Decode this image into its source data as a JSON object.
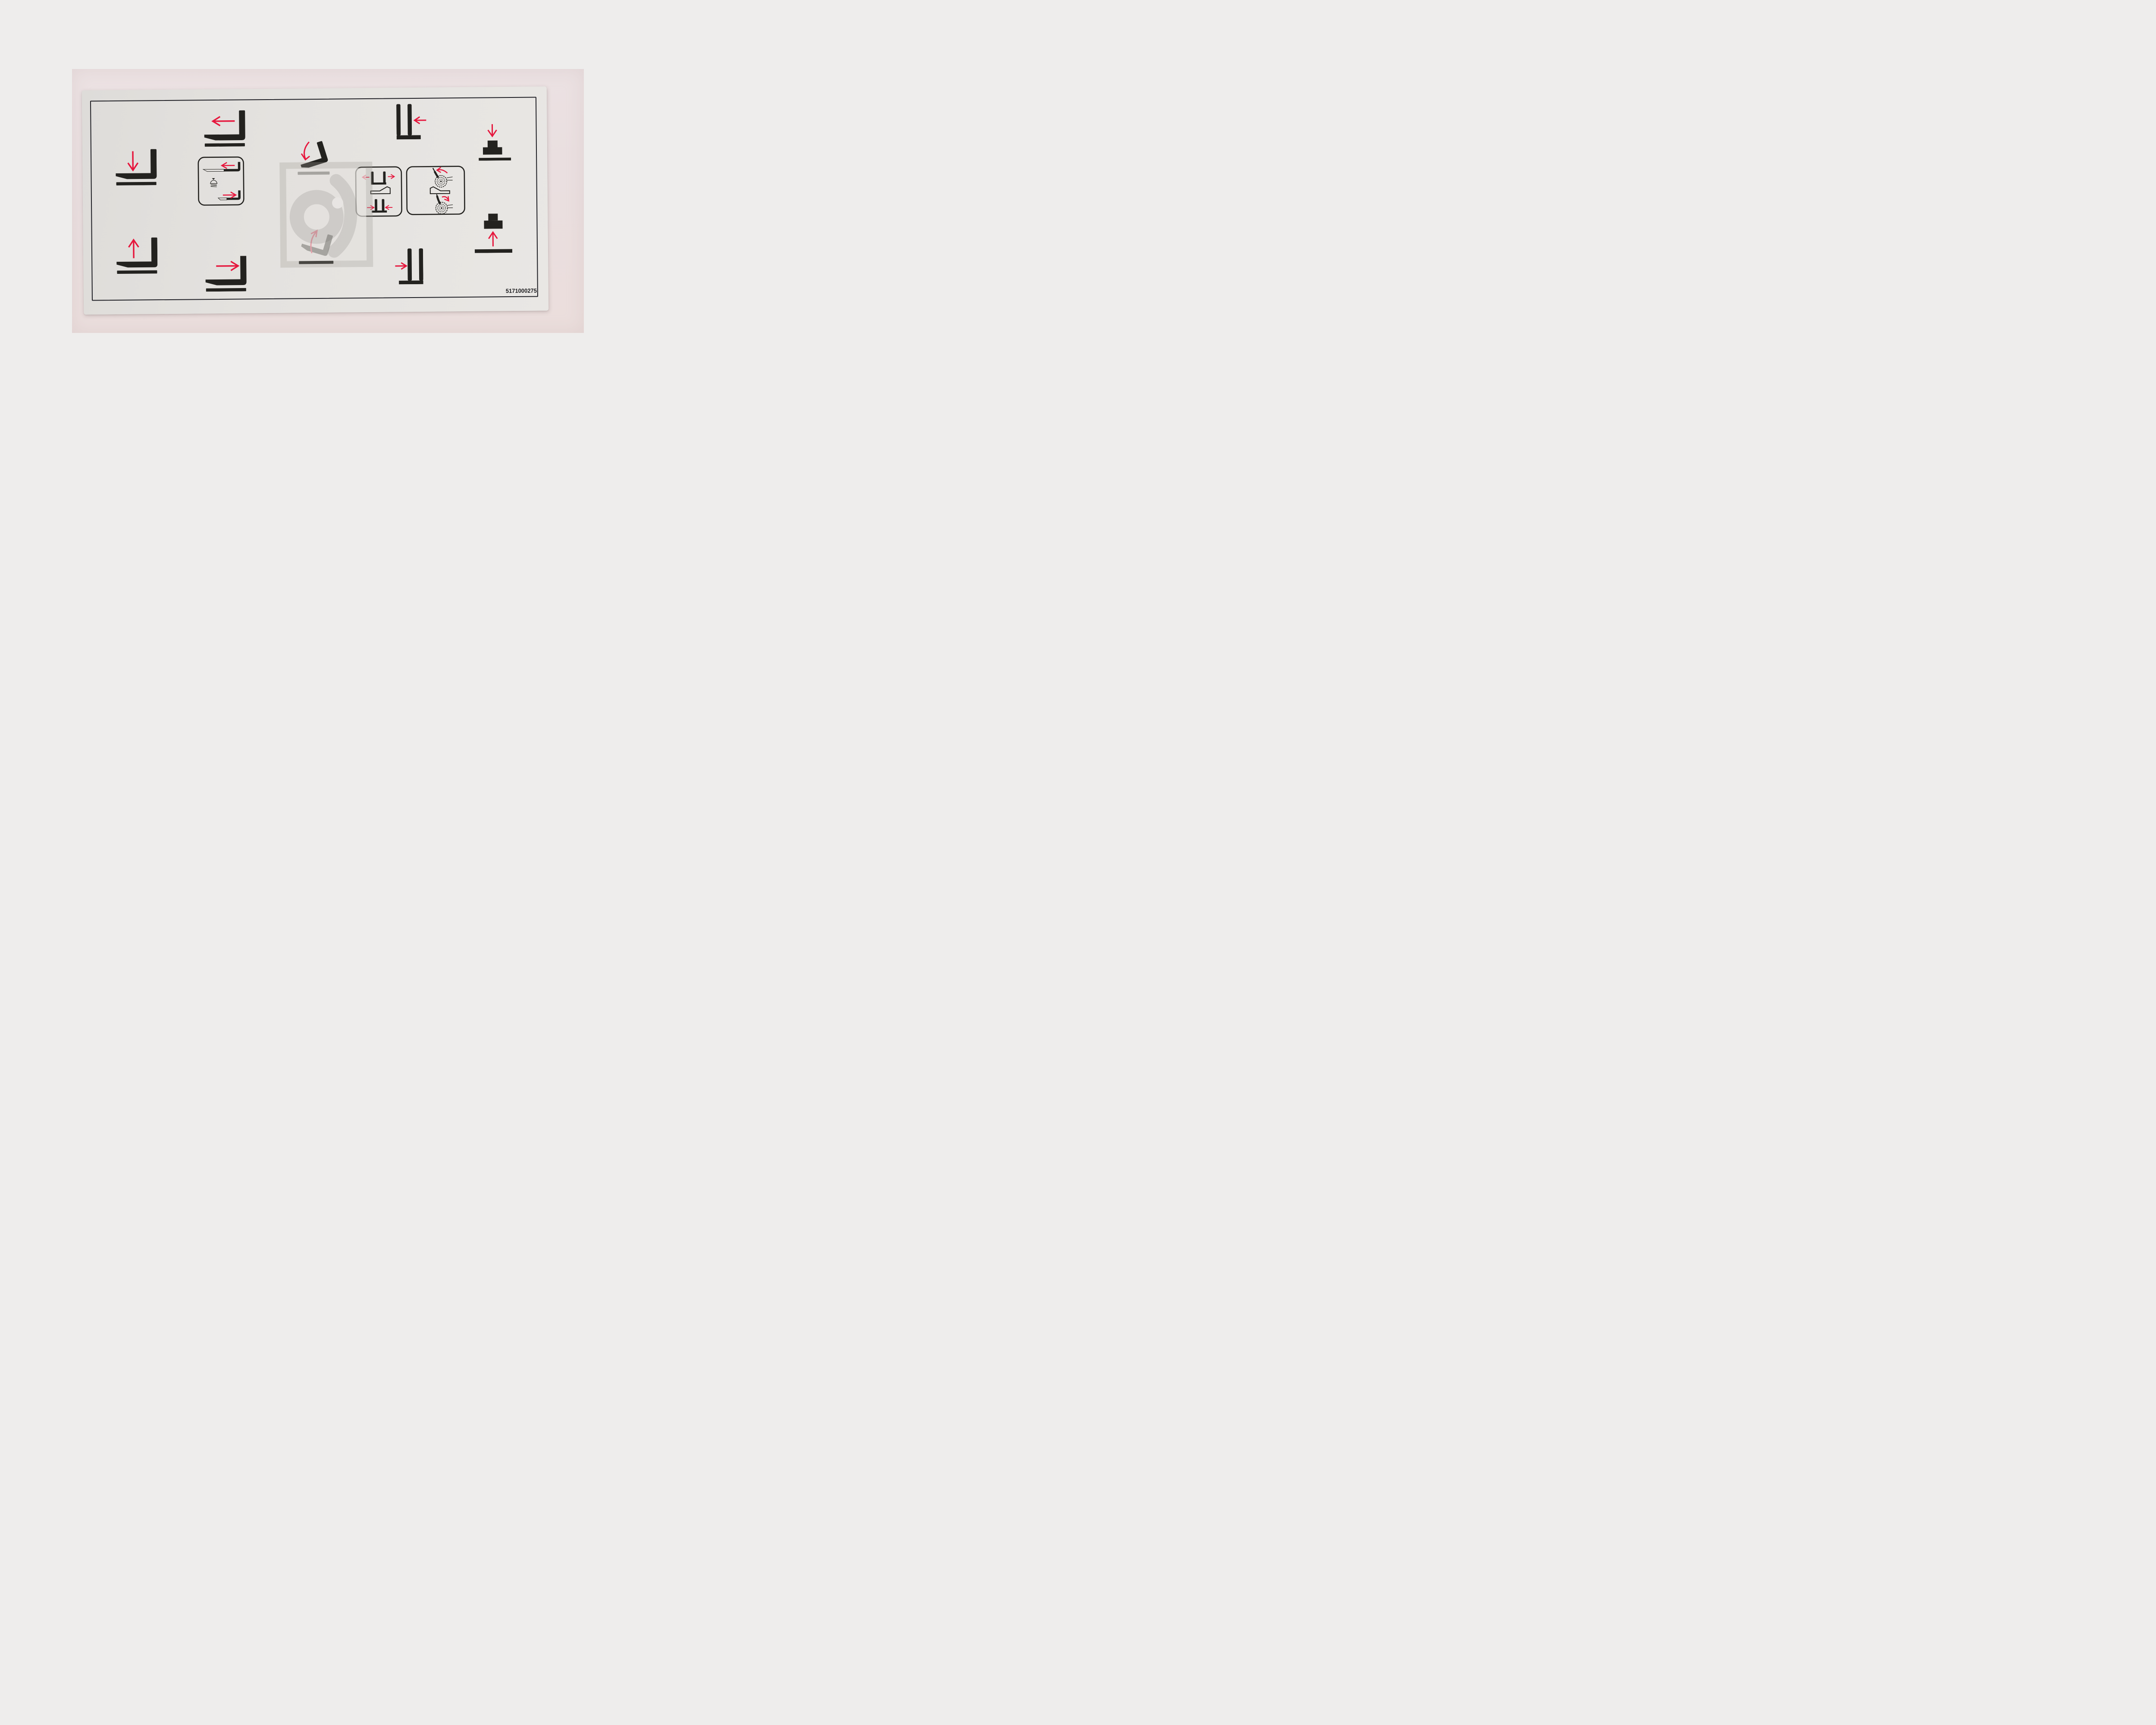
{
  "page": {
    "background_color": "#eeedec"
  },
  "photo": {
    "background_color": "#eadfdf",
    "subject": "control pictogram decal sticker"
  },
  "decal": {
    "part_number": "5171000275",
    "colors": {
      "ink_black": "#23221f",
      "arrow_red": "#e6173d",
      "sticker_face": "#e3e1de",
      "border_line": "#1e1e24",
      "page_background": "#eeedec"
    },
    "pictograms": [
      {
        "id": "fork-lower",
        "label": "Lower forks",
        "arrow": "down"
      },
      {
        "id": "fork-raise",
        "label": "Raise forks",
        "arrow": "up"
      },
      {
        "id": "fork-shift-left",
        "label": "Shift forks left",
        "arrow": "left"
      },
      {
        "id": "fork-shift-right",
        "label": "Shift forks right",
        "arrow": "right"
      },
      {
        "id": "sideshift-detent",
        "label": "Side shift left / right with detent button",
        "arrows": [
          "left",
          "right"
        ]
      },
      {
        "id": "tilt-forward",
        "label": "Tilt forks forward / down",
        "arrow": "curved-down"
      },
      {
        "id": "tilt-back",
        "label": "Tilt forks back / up",
        "arrow": "curved-up"
      },
      {
        "id": "fork-spread-close",
        "label": "Spread forks apart / bring forks together",
        "arrows": [
          "outward",
          "inward"
        ]
      },
      {
        "id": "clamp-rotate",
        "label": "Rotate roll clamp counter-clockwise / clockwise",
        "arrows": [
          "ccw",
          "cw"
        ]
      },
      {
        "id": "carriage-shift-left",
        "label": "Move carriage left",
        "arrow": "left"
      },
      {
        "id": "carriage-shift-right",
        "label": "Move carriage right",
        "arrow": "right"
      },
      {
        "id": "platform-lower",
        "label": "Lower load block",
        "arrow": "down"
      },
      {
        "id": "platform-raise",
        "label": "Raise load block",
        "arrow": "up"
      }
    ],
    "watermark": {
      "shape": "translucent square frame with stylized letter glyph and dot"
    }
  }
}
